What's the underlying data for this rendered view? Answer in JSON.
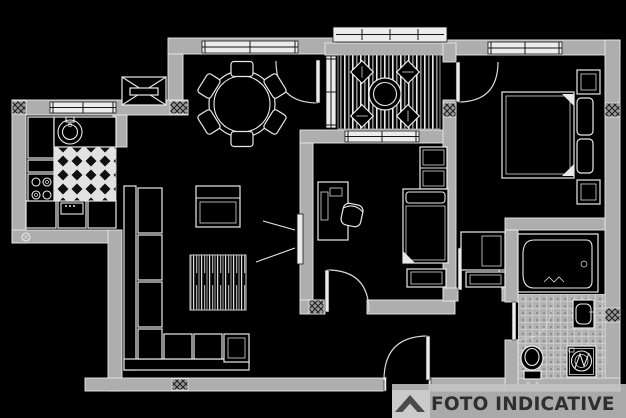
{
  "watermark": {
    "label": "FOTO INDICATIVE",
    "icon": "roof-chevron-icon",
    "band_color": "#c3c3c3",
    "logo_tile_color": "#cdcdcd",
    "icon_color": "#4a4a4a",
    "text_color": "#2f2f2f"
  },
  "plan": {
    "background_color": "#000000",
    "wall_color": "#aeaeae",
    "line_color": "#e9e9e9",
    "elements": [
      "kitchen",
      "dining-area",
      "living-area",
      "balcony",
      "bedroom-small",
      "bedroom-main",
      "bathroom",
      "hallway",
      "entrance-door"
    ]
  }
}
